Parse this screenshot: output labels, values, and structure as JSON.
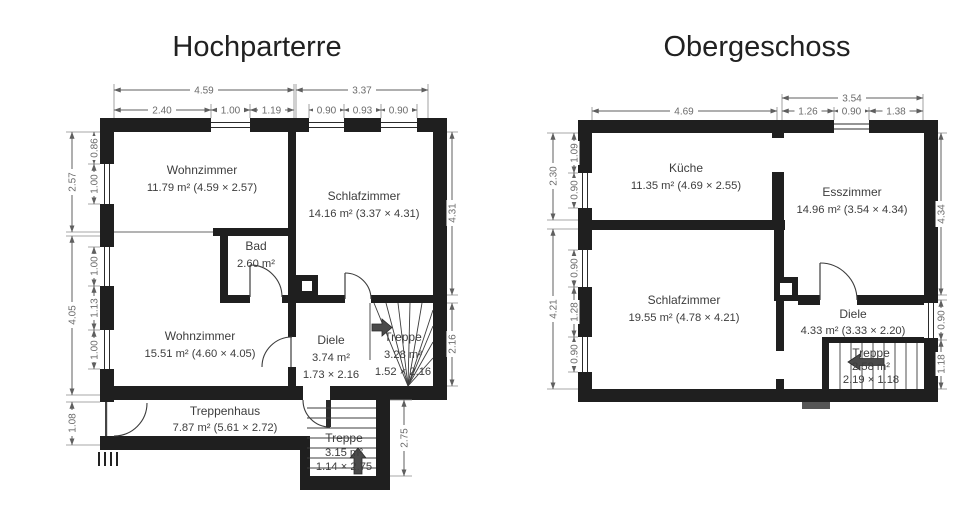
{
  "colors": {
    "wall": "#1f1f1f",
    "dim_text": "#6b6b6b",
    "room_text": "#3d3d3d",
    "stair_arrow": "#4a4a4a",
    "background": "#ffffff"
  },
  "plans": {
    "left": {
      "title": "Hochparterre",
      "rooms": {
        "wz1": {
          "name": "Wohnzimmer",
          "area": "11.79 m² (4.59 × 2.57)"
        },
        "sz": {
          "name": "Schlafzimmer",
          "area": "14.16 m² (3.37 × 4.31)"
        },
        "bad": {
          "name": "Bad",
          "area": "2.60 m²"
        },
        "wz2": {
          "name": "Wohnzimmer",
          "area": "15.51 m² (4.60 × 4.05)"
        },
        "diele": {
          "name": "Diele",
          "area": "3.74 m²",
          "size": "1.73 × 2.16"
        },
        "treppe1": {
          "name": "Treppe",
          "area": "3.28 m²",
          "size": "1.52 × 2.16"
        },
        "treppenhaus": {
          "name": "Treppenhaus",
          "area": "7.87 m² (5.61 × 2.72)"
        },
        "treppe2": {
          "name": "Treppe",
          "area": "3.15 m²",
          "size": "1.14 × 2.75"
        }
      },
      "dims": {
        "t1a": "4.59",
        "t1b": "3.37",
        "t2a": "2.40",
        "t2b": "1.00",
        "t2c": "1.19",
        "t2d": "0.90",
        "t2e": "0.93",
        "t2f": "0.90",
        "lo1": "2.57",
        "lo2": "4.05",
        "lo3": "1.08",
        "li1": "0.86",
        "li2": "1.00",
        "li3": "1.00",
        "li4": "1.13",
        "li5": "1.00",
        "r1": "4.31",
        "r2": "2.16",
        "r3": "2.75"
      }
    },
    "right": {
      "title": "Obergeschoss",
      "rooms": {
        "kueche": {
          "name": "Küche",
          "area": "11.35 m² (4.69 × 2.55)"
        },
        "esszimmer": {
          "name": "Esszimmer",
          "area": "14.96 m² (3.54 × 4.34)"
        },
        "sz": {
          "name": "Schlafzimmer",
          "area": "19.55 m² (4.78 × 4.21)"
        },
        "diele": {
          "name": "Diele",
          "area": "4.33 m² (3.33 × 2.20)"
        },
        "treppe": {
          "name": "Treppe",
          "area": "2.58 m²",
          "size": "2.19 × 1.18"
        }
      },
      "dims": {
        "t1": "3.54",
        "t2a": "4.69",
        "t2b": "1.26",
        "t2c": "0.90",
        "t2d": "1.38",
        "lo1": "2.30",
        "lo2": "4.21",
        "li1": "1.09",
        "li2": "0.90",
        "li3": "0.90",
        "li4": "1.28",
        "li5": "0.90",
        "r1": "4.34",
        "r2": "0.90",
        "r3": "1.18"
      }
    }
  }
}
